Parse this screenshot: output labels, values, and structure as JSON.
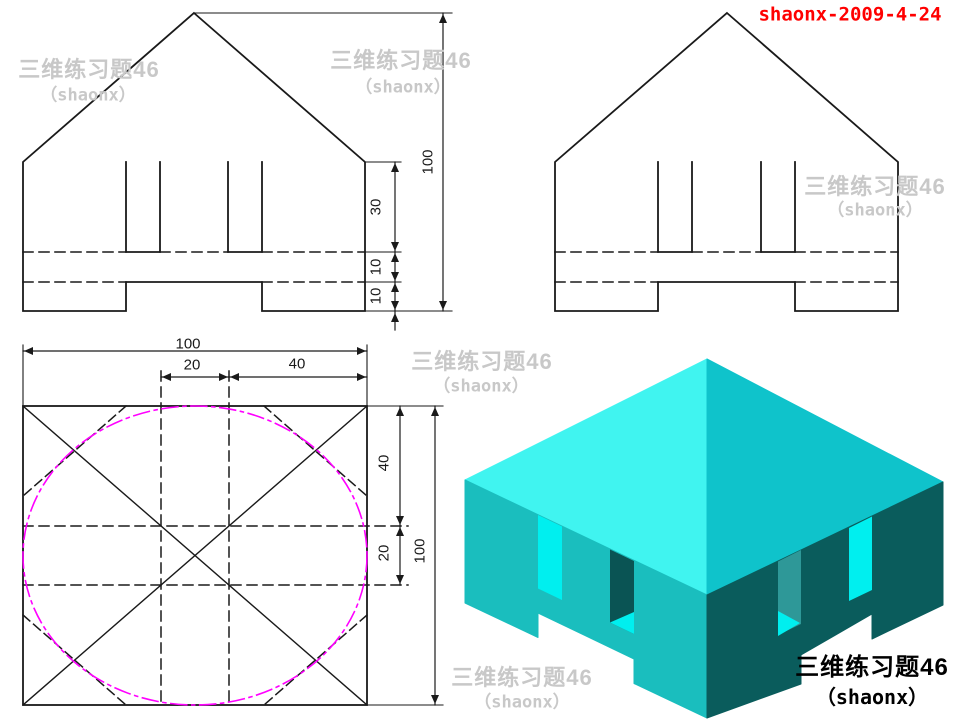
{
  "stamp": {
    "text": "shaonx-2009-4-24",
    "color": "#FF0000"
  },
  "watermark": {
    "line1": "三维练习题46",
    "line2": "（shaonx）",
    "color": "#C8C8C8"
  },
  "title_block": {
    "line1": "三维练习题46",
    "line2": "（shaonx）",
    "color": "#000000"
  },
  "dims": {
    "front_view": {
      "slot_depth": "30",
      "web_height": "10",
      "leg_height": "10",
      "total_height": "100"
    },
    "plan_view": {
      "total_width": "100",
      "slot_width": "20",
      "slot_to_edge": "40",
      "top_depth": "40",
      "mid_depth": "20",
      "total_depth": "100"
    }
  },
  "colors": {
    "line": "#1A1A1A",
    "centerline_circle": "#FF00FF",
    "iso_roof_left": "#40F4F0",
    "iso_roof_right": "#0FC3CB",
    "iso_wall_left": "#1ABEBE",
    "iso_wall_right": "#0A5C5C",
    "iso_slot_bright": "#00EFEF",
    "iso_slot_shadow": "#0A5454",
    "iso_slot_muted": "#2E9898"
  }
}
